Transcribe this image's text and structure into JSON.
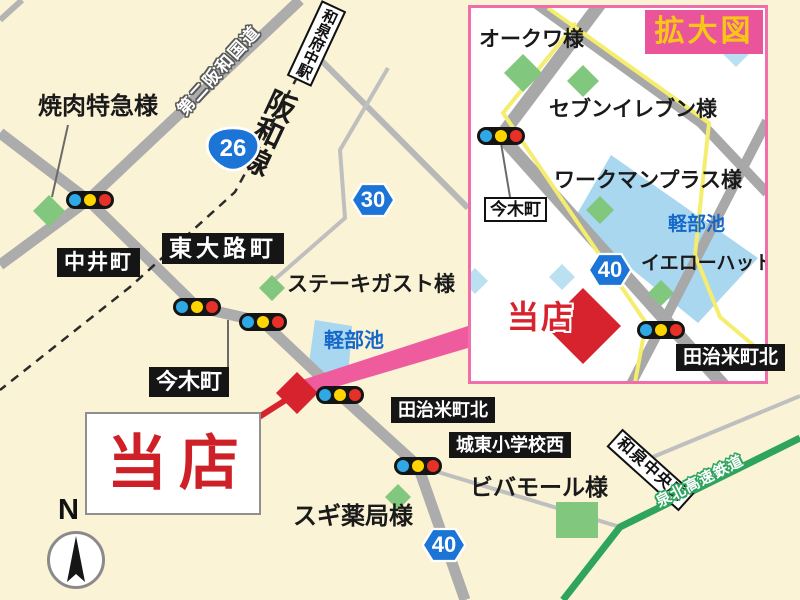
{
  "main_map": {
    "poi": {
      "yakiniku": "焼肉特急様",
      "steak_gust": "ステーキガスト様",
      "vivamall": "ビバモール様",
      "sugi_pharmacy": "スギ薬局様"
    },
    "place_boxes": {
      "nakaicho": "中井町",
      "higashiojicho": "東大路町",
      "imakicho": "今木町",
      "tajime_kita": "田治米町北",
      "joto_shogakko_nishi": "城東小学校西"
    },
    "pond": "軽部池",
    "store_label": "当店",
    "railways": {
      "hanwa_line": "阪和線",
      "izumi_fuchu_station": "和泉府中駅",
      "izumi_chuo_station": "和泉中央駅",
      "semboku_line": "泉北高速鉄道"
    },
    "road_names": {
      "dai2_hanwa": "第二阪和国道"
    },
    "shields": {
      "r26": "26",
      "r30": "30",
      "r40": "40"
    },
    "compass": "N"
  },
  "inset": {
    "title": "拡大図",
    "poi": {
      "okuwa": "オークワ様",
      "seven_eleven": "セブンイレブン様",
      "workman_plus": "ワークマンプラス様",
      "yellow_hat": "イエローハット様"
    },
    "place_boxes": {
      "imakicho": "今木町",
      "tajime_kita": "田治米町北"
    },
    "pond": "軽部池",
    "store_label": "当店",
    "shield_40": "40"
  },
  "colors": {
    "background_cream": "#FAF3D5",
    "road_gray": "#ACACAC",
    "yellow_road": "#F5ED6E",
    "pond_blue": "#A9D7F0",
    "pond_text_blue": "#1668C8",
    "landmark_green": "#82C77E",
    "rail_green_line": "#2EA45E",
    "shield_blue": "#1B74D6",
    "store_red": "#D7232E",
    "inset_pink": "#F06EA9",
    "badge_pink": "#E9549B",
    "badge_yellow": "#F8C716",
    "signal_blue": "#2FA9E6",
    "signal_yellow": "#FFD400",
    "signal_red": "#E63128"
  }
}
